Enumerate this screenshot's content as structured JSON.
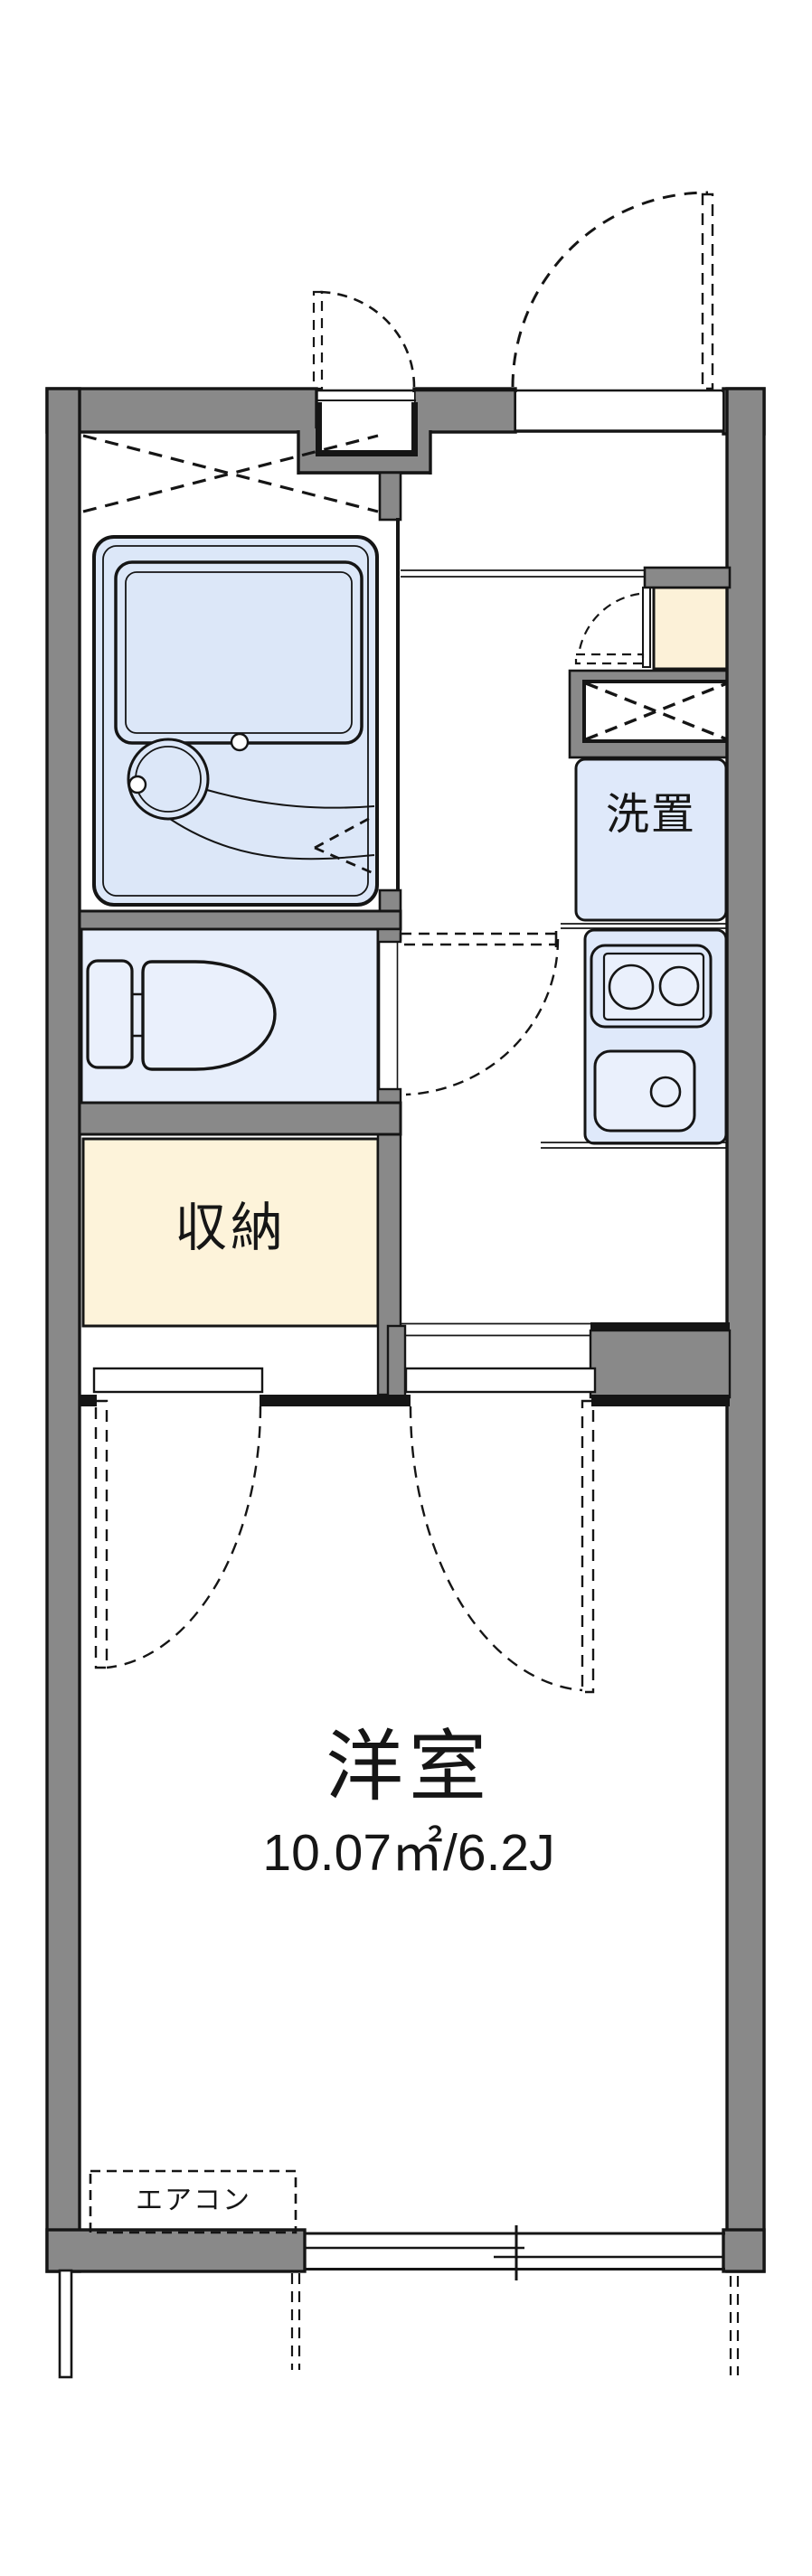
{
  "title": "1K apartment floor plan",
  "labels": {
    "storage": "収納",
    "washer": "洗置",
    "room": "洋室",
    "room_size": "10.07㎡/6.2J",
    "aircon": "エアコン"
  },
  "rooms": [
    {
      "name": "unit-bath",
      "label": ""
    },
    {
      "name": "toilet",
      "label": ""
    },
    {
      "name": "storage",
      "label": "収納"
    },
    {
      "name": "washer-space",
      "label": "洗置"
    },
    {
      "name": "kitchen",
      "label": ""
    },
    {
      "name": "western-room",
      "label": "洋室",
      "area": "10.07㎡/6.2J"
    },
    {
      "name": "air-conditioner",
      "label": "エアコン"
    }
  ],
  "colors": {
    "bg": "#ffffff",
    "wall": "#898989",
    "outline": "#151515",
    "bath": "#dce7f8",
    "fixture": "#eaf0fc",
    "toilet_room": "#e7eefb",
    "kitchen": "#dfe9fa",
    "storage": "#fdf3da",
    "cabinet": "#fcf1d8"
  }
}
